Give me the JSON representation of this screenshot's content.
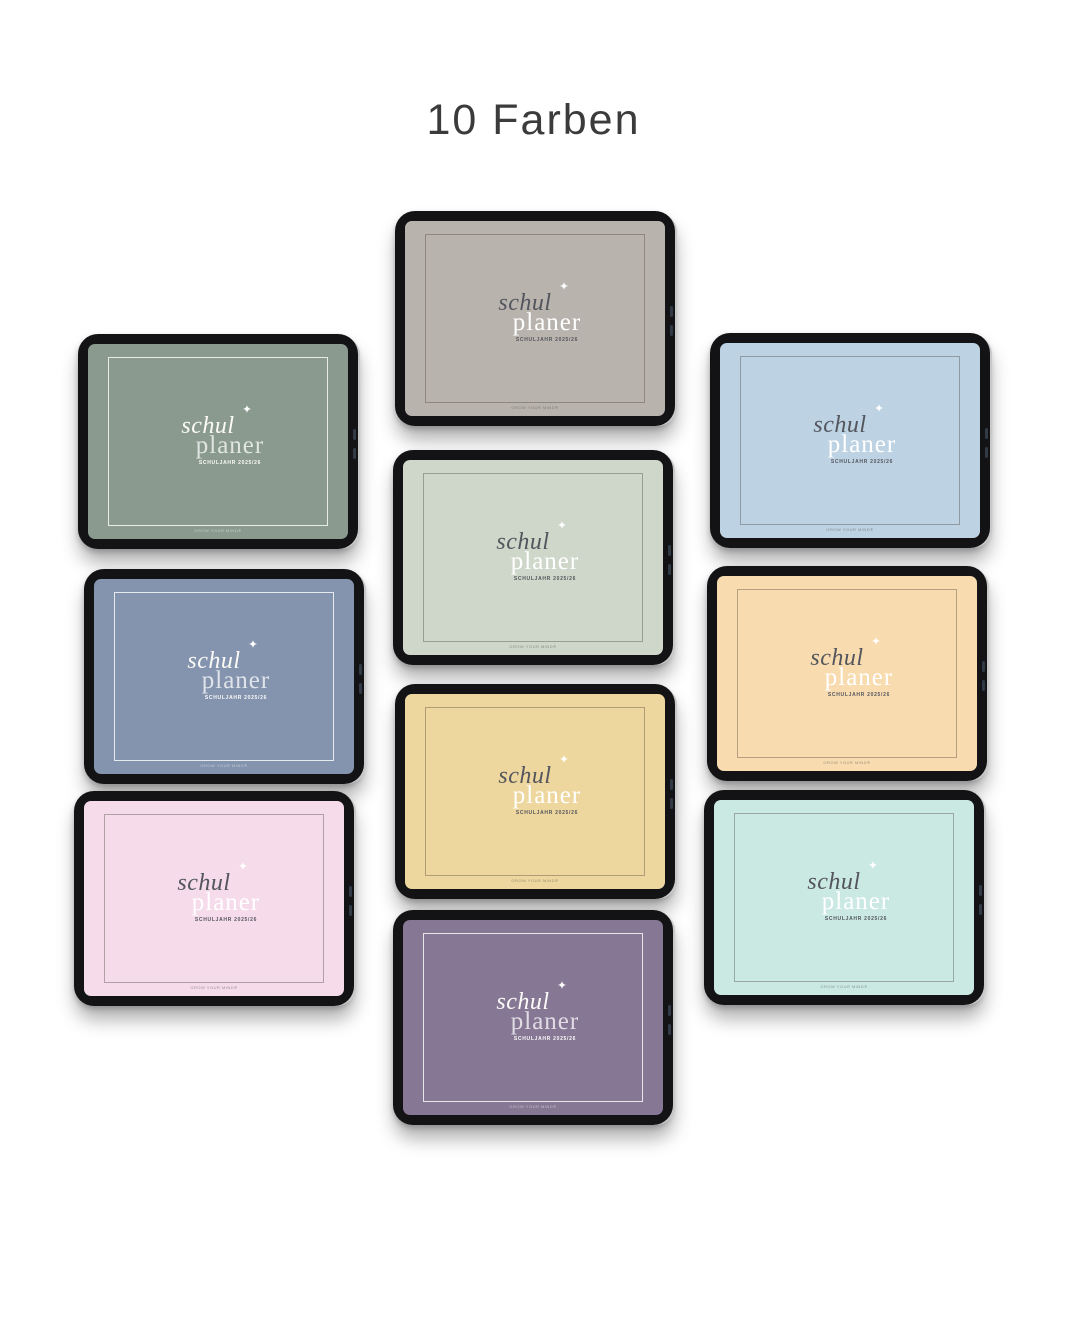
{
  "page": {
    "title": "10 Farben"
  },
  "cover": {
    "word_top": "schul",
    "word_bottom": "planer",
    "sparkle_icon": "✦",
    "subtitle": "SCHULJAHR 2025/26",
    "watermark": "GROW YOUR MIND®"
  },
  "colors": {
    "frame": "#131316",
    "dark_text": "#54565e",
    "light_text": "#fbfaf7"
  },
  "tablets": [
    {
      "name": "greige",
      "screen_color": "#b8b3ad",
      "text_variant": "dark-text"
    },
    {
      "name": "sage-green",
      "screen_color": "#8a9a8e",
      "text_variant": "light-text"
    },
    {
      "name": "light-blue",
      "screen_color": "#bdd2e2",
      "text_variant": "dark-text"
    },
    {
      "name": "pale-sage",
      "screen_color": "#ced7ca",
      "text_variant": "dark-text"
    },
    {
      "name": "slate-blue",
      "screen_color": "#8494ae",
      "text_variant": "light-text"
    },
    {
      "name": "apricot",
      "screen_color": "#f8dcb0",
      "text_variant": "dark-text"
    },
    {
      "name": "vanilla-yellow",
      "screen_color": "#eed79e",
      "text_variant": "dark-text"
    },
    {
      "name": "rose-pink",
      "screen_color": "#f6dcea",
      "text_variant": "dark-text"
    },
    {
      "name": "aqua-mint",
      "screen_color": "#cbe9e3",
      "text_variant": "dark-text"
    },
    {
      "name": "mauve-purple",
      "screen_color": "#867795",
      "text_variant": "light-text"
    }
  ]
}
